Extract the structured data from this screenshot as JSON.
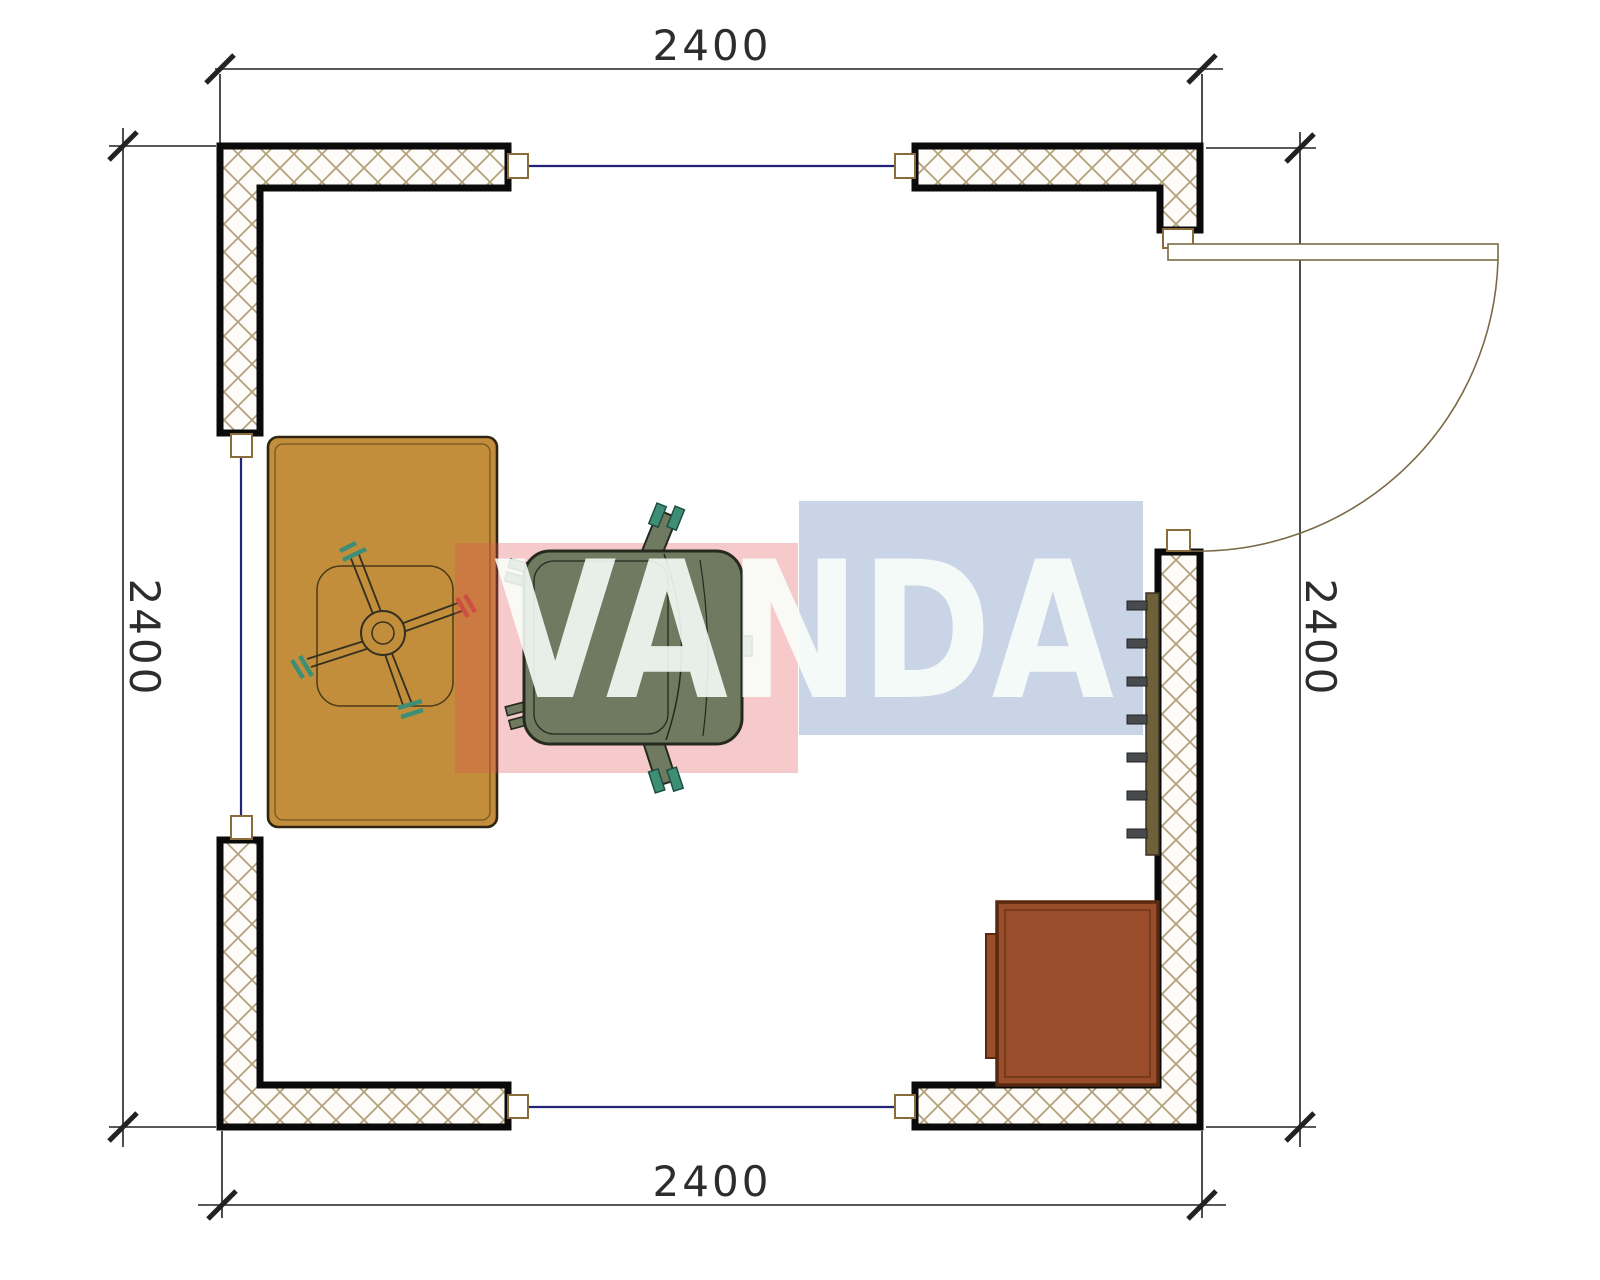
{
  "plan": {
    "title": "room-floor-plan",
    "dimensions": {
      "top": "2400",
      "bottom": "2400",
      "left": "2400",
      "right": "2400",
      "unit": "mm"
    },
    "watermark": {
      "text": "VANDA",
      "pink_block_color": "#E14B52",
      "blue_block_color": "#3C64A5"
    },
    "colors": {
      "wall_hatch": "#B4A27C",
      "wall_outline": "#0a0a0a",
      "window_glass_line": "#23237A",
      "window_frame": "#8A6B3A",
      "desk": "#C28E3C",
      "chair_body": "#6F7A61",
      "chair_accent_teal": "#3E8E76",
      "chair_caster_red": "#C4503C",
      "cabinet": "#9A4D2B",
      "radiator_bar": "#6E6038",
      "radiator_fin": "#474B4D",
      "door_line": "#7A6A45"
    },
    "objects": [
      "desk",
      "office-chair",
      "cabinet",
      "radiator",
      "door",
      "window-top",
      "window-left",
      "window-bottom"
    ]
  }
}
